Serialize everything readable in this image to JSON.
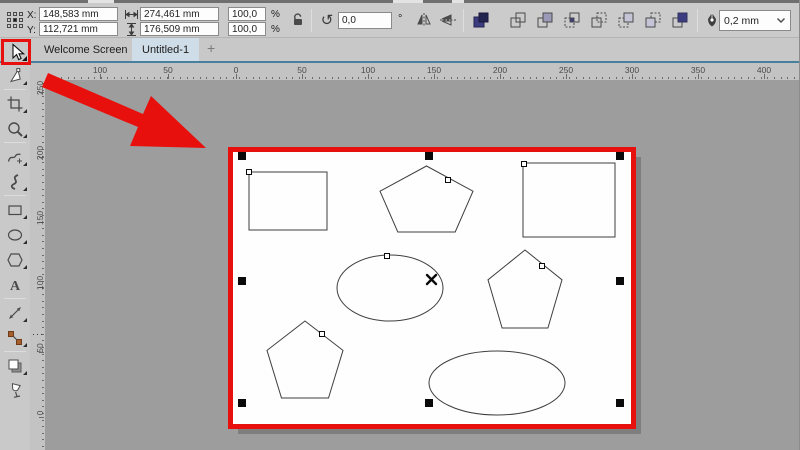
{
  "property_bar": {
    "x_label": "X:",
    "x_value": "148,583 mm",
    "y_label": "Y:",
    "y_value": "112,721 mm",
    "width_value": "274,461 mm",
    "height_value": "176,509 mm",
    "scale_h": "100,0",
    "scale_v": "100,0",
    "percent": "%",
    "rotation_value": "0,0",
    "degree_symbol": "°",
    "outline_width_value": "0,2 mm"
  },
  "tabs": {
    "items": [
      {
        "label": "Welcome Screen",
        "active": false
      },
      {
        "label": "Untitled-1",
        "active": true
      }
    ],
    "new_tab_label": "+"
  },
  "toolbox": {
    "tools": [
      {
        "name": "shape",
        "flyout": true
      },
      {
        "name": "crop",
        "flyout": true
      },
      {
        "name": "zoom",
        "flyout": true
      },
      {
        "name": "freehand",
        "flyout": true
      },
      {
        "name": "artistic-media",
        "flyout": true
      },
      {
        "name": "rectangle",
        "flyout": true
      },
      {
        "name": "ellipse",
        "flyout": true
      },
      {
        "name": "polygon",
        "flyout": true
      },
      {
        "name": "text",
        "flyout": false
      },
      {
        "name": "dimension",
        "flyout": true
      },
      {
        "name": "connector",
        "flyout": true
      },
      {
        "name": "drop-shadow",
        "flyout": true
      },
      {
        "name": "transparency",
        "flyout": false
      }
    ],
    "separators_after": [
      "shape",
      "zoom",
      "artistic-media",
      "text",
      "connector"
    ]
  },
  "rulers": {
    "horizontal": {
      "labels": [
        "100",
        "50",
        "0",
        "50",
        "100",
        "150",
        "200",
        "250",
        "300",
        "350",
        "400"
      ],
      "positions": [
        100,
        168,
        236,
        302,
        368,
        434,
        500,
        566,
        632,
        698,
        764
      ]
    },
    "vertical": {
      "labels": [
        "250",
        "200",
        "150",
        "100",
        "50",
        "0"
      ],
      "positions": [
        92,
        157,
        222,
        287,
        352,
        417
      ]
    }
  },
  "canvas": {
    "page": {
      "x": 233,
      "y": 152,
      "w": 400,
      "h": 274
    },
    "highlight_border": {
      "x": 228,
      "y": 147,
      "w": 408,
      "h": 282
    },
    "shapes": [
      {
        "type": "rect",
        "x": 249,
        "y": 172,
        "w": 78,
        "h": 58
      },
      {
        "type": "pentagon",
        "x": 380,
        "y": 166,
        "w": 93,
        "h": 66
      },
      {
        "type": "rect",
        "x": 523,
        "y": 163,
        "w": 92,
        "h": 74
      },
      {
        "type": "ellipse",
        "cx": 390,
        "cy": 288,
        "rx": 53,
        "ry": 33
      },
      {
        "type": "pentagon",
        "x": 488,
        "y": 250,
        "w": 74,
        "h": 78
      },
      {
        "type": "pentagon",
        "x": 267,
        "y": 321,
        "w": 76,
        "h": 77
      },
      {
        "type": "ellipse",
        "cx": 497,
        "cy": 383,
        "rx": 68,
        "ry": 32
      }
    ],
    "selection": {
      "handles": [
        [
          242,
          156
        ],
        [
          429,
          156
        ],
        [
          620,
          156
        ],
        [
          242,
          281
        ],
        [
          620,
          281
        ],
        [
          242,
          403
        ],
        [
          429,
          403
        ],
        [
          620,
          403
        ]
      ],
      "nodes": [
        [
          249,
          172
        ],
        [
          448,
          180
        ],
        [
          524,
          164
        ],
        [
          387,
          256
        ],
        [
          542,
          266
        ],
        [
          322,
          334
        ]
      ],
      "center_mark": [
        431.5,
        279.5
      ]
    }
  },
  "annotations": {
    "arrow_points": "42,87 48,73 143,114 151,96 206,148 130,146 138,127",
    "tool_highlight": {
      "x": 1,
      "y": 39,
      "w": 30,
      "h": 26
    }
  },
  "colors": {
    "chrome": "#cbcbcb",
    "canvas_bg": "#9d9d9d",
    "accent_line": "#47809c",
    "active_tab": "#cfdde9",
    "annotation_red": "#e8100c",
    "shape_stroke": "#3f3f3f"
  }
}
